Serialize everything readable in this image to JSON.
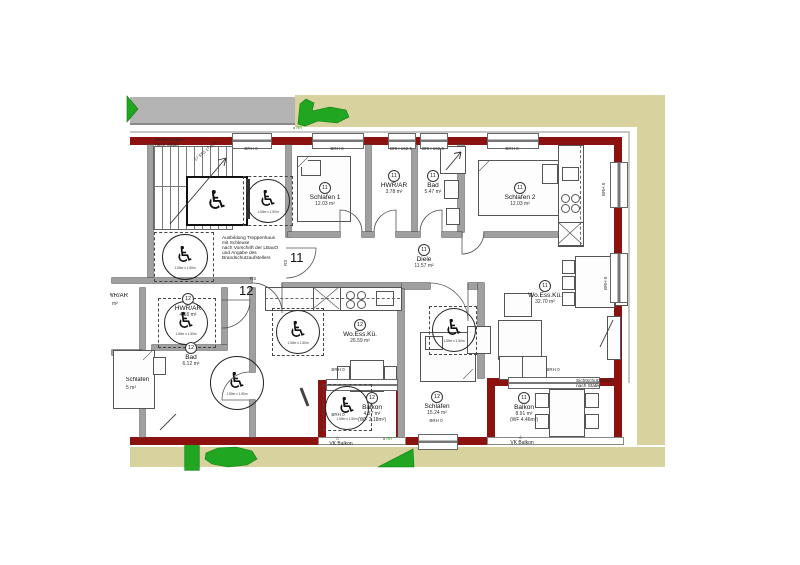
{
  "site": {
    "vk_balkon": "VK Balkon",
    "rr": "RR"
  },
  "dims": {
    "brh0": "BRH 0",
    "brh1625": "BRH 162.5"
  },
  "notes": {
    "massivtreppe": [
      "Massivtreppe",
      "nach Statik"
    ],
    "stg": "17 STG 17,6/28",
    "schleuse": [
      "Ausbildung Treppenhaus",
      "mit Schleuse",
      "nach Vorschrift der LBauO",
      "und Angabe des",
      "Brandschutzaufstellers"
    ],
    "sichtschutz": [
      "Sichtschutzwand",
      "nach Statik"
    ],
    "wc_dim": "1.50m x 1.50m"
  },
  "apartments": [
    {
      "unit": "11",
      "rs": "RS",
      "rooms": [
        {
          "name": "Schlafen 1",
          "area": "12.03 m²"
        },
        {
          "name": "HWR/AR",
          "area": "3.78 m²"
        },
        {
          "name": "Bad",
          "area": "5.47 m²"
        },
        {
          "name": "Schlafen 2",
          "area": "12.03 m²"
        },
        {
          "name": "Diele",
          "area": "11.57 m²"
        },
        {
          "name": "Wo.Ess.Kü.",
          "area": "32.70 m²"
        },
        {
          "name": "Balkon",
          "area": "8.91 m²",
          "area_extra": "(WF 4.46m²)"
        }
      ]
    },
    {
      "unit": "12",
      "rs": "RS",
      "rooms": [
        {
          "name": "HWR/AR",
          "area": "4.16 m²"
        },
        {
          "name": "Bad",
          "area": "6.12 m²"
        },
        {
          "name": "Wo.Ess.Kü.",
          "area": "26.59 m²"
        },
        {
          "name": "Schlafen",
          "area": "15.24 m²"
        },
        {
          "name": "Balkon",
          "area": "4.37 m²",
          "area_extra": "(WF 2.18m²)"
        }
      ]
    }
  ],
  "partials": {
    "r1_name": "HWR/AR",
    "r1_area": "m²",
    "r2_name": "Schlafen",
    "r2_area": "5 m²"
  }
}
